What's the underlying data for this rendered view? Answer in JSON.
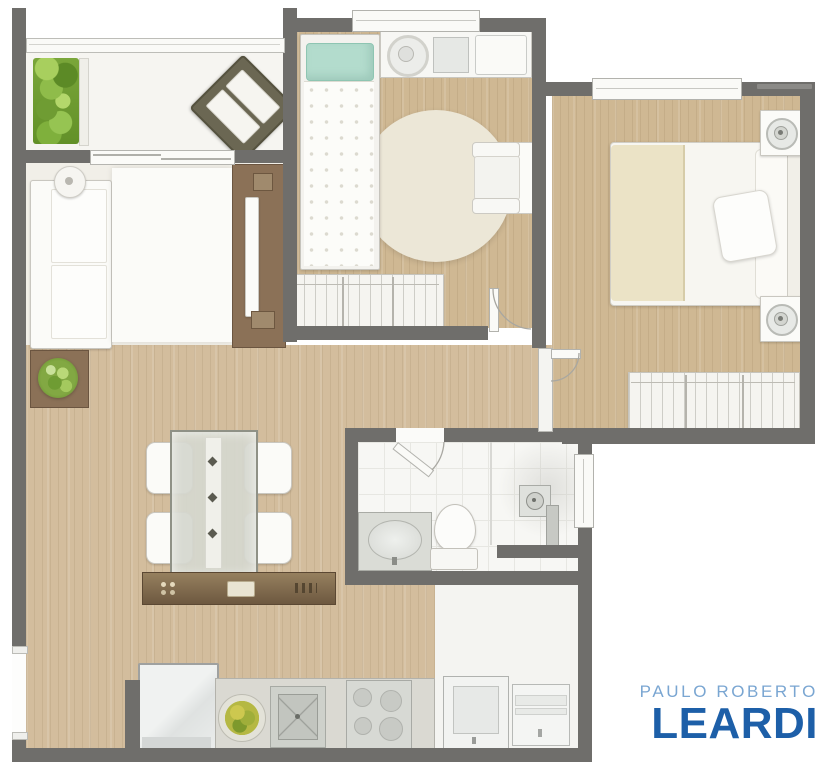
{
  "logo": {
    "line1": "PAULO ROBERTO",
    "line2": "LEARDI",
    "light_blue": "#7aa6d2",
    "dark_blue": "#1d5fa8"
  },
  "palette": {
    "wall": "#6f6e6b",
    "wood_floor": "#d3bd9d",
    "tile_floor": "#f7f7f4",
    "furniture_brown": "#8b7157",
    "teal_pillow": "#b3dccd",
    "blanket_beige": "#ebe3c6",
    "plant_green": "#82a843"
  },
  "rooms": [
    {
      "id": "balcony",
      "items": [
        "railing",
        "vertical-garden",
        "lounge-chair",
        "sliding-door"
      ]
    },
    {
      "id": "living-room",
      "items": [
        "sofa",
        "floor-lamp",
        "area-rug",
        "tv-panel",
        "television",
        "plant-table",
        "plant"
      ]
    },
    {
      "id": "dining-area",
      "items": [
        "glass-dining-table",
        "table-runner",
        "dining-chair-1",
        "dining-chair-2",
        "dining-chair-3",
        "dining-chair-4",
        "sideboard"
      ]
    },
    {
      "id": "kitchen",
      "items": [
        "refrigerator",
        "countertop",
        "fruit-bowl",
        "kitchen-sink",
        "cooktop",
        "entry-opening"
      ]
    },
    {
      "id": "service-area",
      "items": [
        "laundry-tub",
        "washer-space"
      ]
    },
    {
      "id": "bathroom",
      "items": [
        "vanity-sink",
        "toilet",
        "shower-head",
        "shower-column",
        "shower-half-wall",
        "bathroom-window",
        "bathroom-door"
      ]
    },
    {
      "id": "master-bedroom",
      "items": [
        "double-bed",
        "pillow",
        "beige-blanket",
        "headboard",
        "nightstand-top",
        "nightstand-bottom",
        "wardrobe",
        "bedroom-door",
        "window"
      ]
    },
    {
      "id": "bedroom-2",
      "items": [
        "single-bed",
        "teal-pillow",
        "dresser",
        "round-mirror",
        "round-rug",
        "armchair",
        "wardrobe",
        "bedroom-door",
        "window"
      ]
    }
  ]
}
